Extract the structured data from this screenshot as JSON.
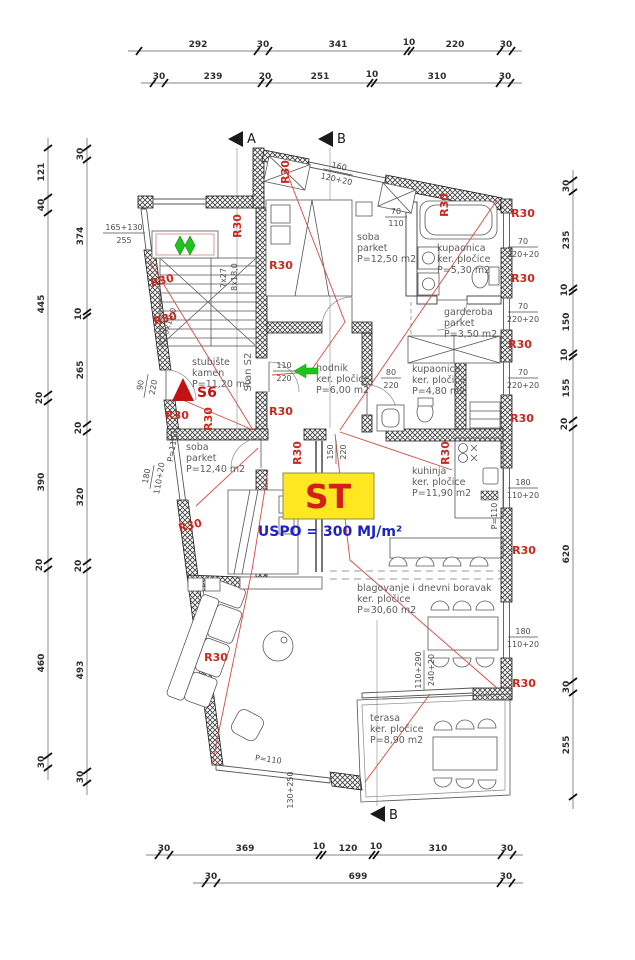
{
  "drawing": {
    "type": "apartment floor plan",
    "unit_code": "Stan S2"
  },
  "dims": {
    "top1": [
      "292",
      "30",
      "341",
      "10",
      "220",
      "30"
    ],
    "top2": [
      "30",
      "239",
      "20",
      "251",
      "10",
      "310",
      "30"
    ],
    "bottom1": [
      "30",
      "369",
      "10",
      "120",
      "10",
      "310",
      "30"
    ],
    "bottom2": [
      "30",
      "699",
      "30"
    ],
    "left_outer": [
      "121",
      "40",
      "445",
      "20",
      "390",
      "20",
      "460",
      "30"
    ],
    "left_inner": [
      "30",
      "374",
      "10",
      "265",
      "20",
      "320",
      "20",
      "493",
      "30"
    ],
    "right": [
      "30",
      "235",
      "10",
      "150",
      "10",
      "155",
      "20",
      "620",
      "30",
      "255"
    ]
  },
  "markers": {
    "a": "A",
    "b": "B"
  },
  "rooms": {
    "soba1": {
      "name": "soba",
      "floor": "parket",
      "area": "P=12,50 m2"
    },
    "kupaonica1": {
      "name": "kupaonica",
      "floor": "ker. pločice",
      "area": "P=5,30 m2"
    },
    "garderoba": {
      "name": "garderoba",
      "floor": "parket",
      "area": "P=3,50 m2"
    },
    "hodnik": {
      "name": "hodnik",
      "floor": "ker. pločice",
      "area": "P=6,00 m2"
    },
    "kupaonica2": {
      "name": "kupaonica",
      "floor": "ker. pločice",
      "area": "P=4,80 m2"
    },
    "stubiste": {
      "name": "stubište",
      "floor": "kamen",
      "area": "P=11,20 m2"
    },
    "soba2": {
      "name": "soba",
      "floor": "parket",
      "area": "P=12,40 m2"
    },
    "kuhinja": {
      "name": "kuhinja",
      "floor": "ker. pločice",
      "area": "P=11,90 m2"
    },
    "blagovanje": {
      "name": "blagovanje i dnevni boravak",
      "floor": "ker. pločice",
      "area": "P=30,60 m2"
    },
    "terasa": {
      "name": "terasa",
      "floor": "ker. pločice",
      "area": "P=8,90 m2"
    }
  },
  "fire": {
    "r30": "R30",
    "s6": "S6"
  },
  "unit": {
    "st": "ST",
    "uspo": "USPO = 300 MJ/m²",
    "stan": "Stan S2"
  },
  "openings": {
    "w70_110": {
      "a": "70",
      "b": "110"
    },
    "w70_220": {
      "a": "70",
      "b": "220+20"
    },
    "w180_110": {
      "a": "180",
      "b": "110+20"
    },
    "d110_220": {
      "a": "110",
      "b": "220"
    },
    "d80_220": {
      "a": "80",
      "b": "220"
    },
    "d90_220": {
      "a": "90",
      "b": "220"
    },
    "w165": {
      "a": "165+130",
      "b": "255"
    },
    "w160": {
      "a": "160",
      "b": "120+20"
    },
    "d150": {
      "a": "150",
      "b": "220"
    },
    "w110_290": {
      "a": "110+290",
      "b": "240+20"
    },
    "w130": "130+250",
    "p110": "P=110"
  },
  "stairs": {
    "run1": "7x27",
    "run2": "8x18,0",
    "run3": "9x18,0"
  },
  "colors": {
    "fire_red": "#c8281e",
    "unit_yellow": "#ffe821",
    "energy_blue": "#1c23c4",
    "route_green": "#1ec41e"
  }
}
